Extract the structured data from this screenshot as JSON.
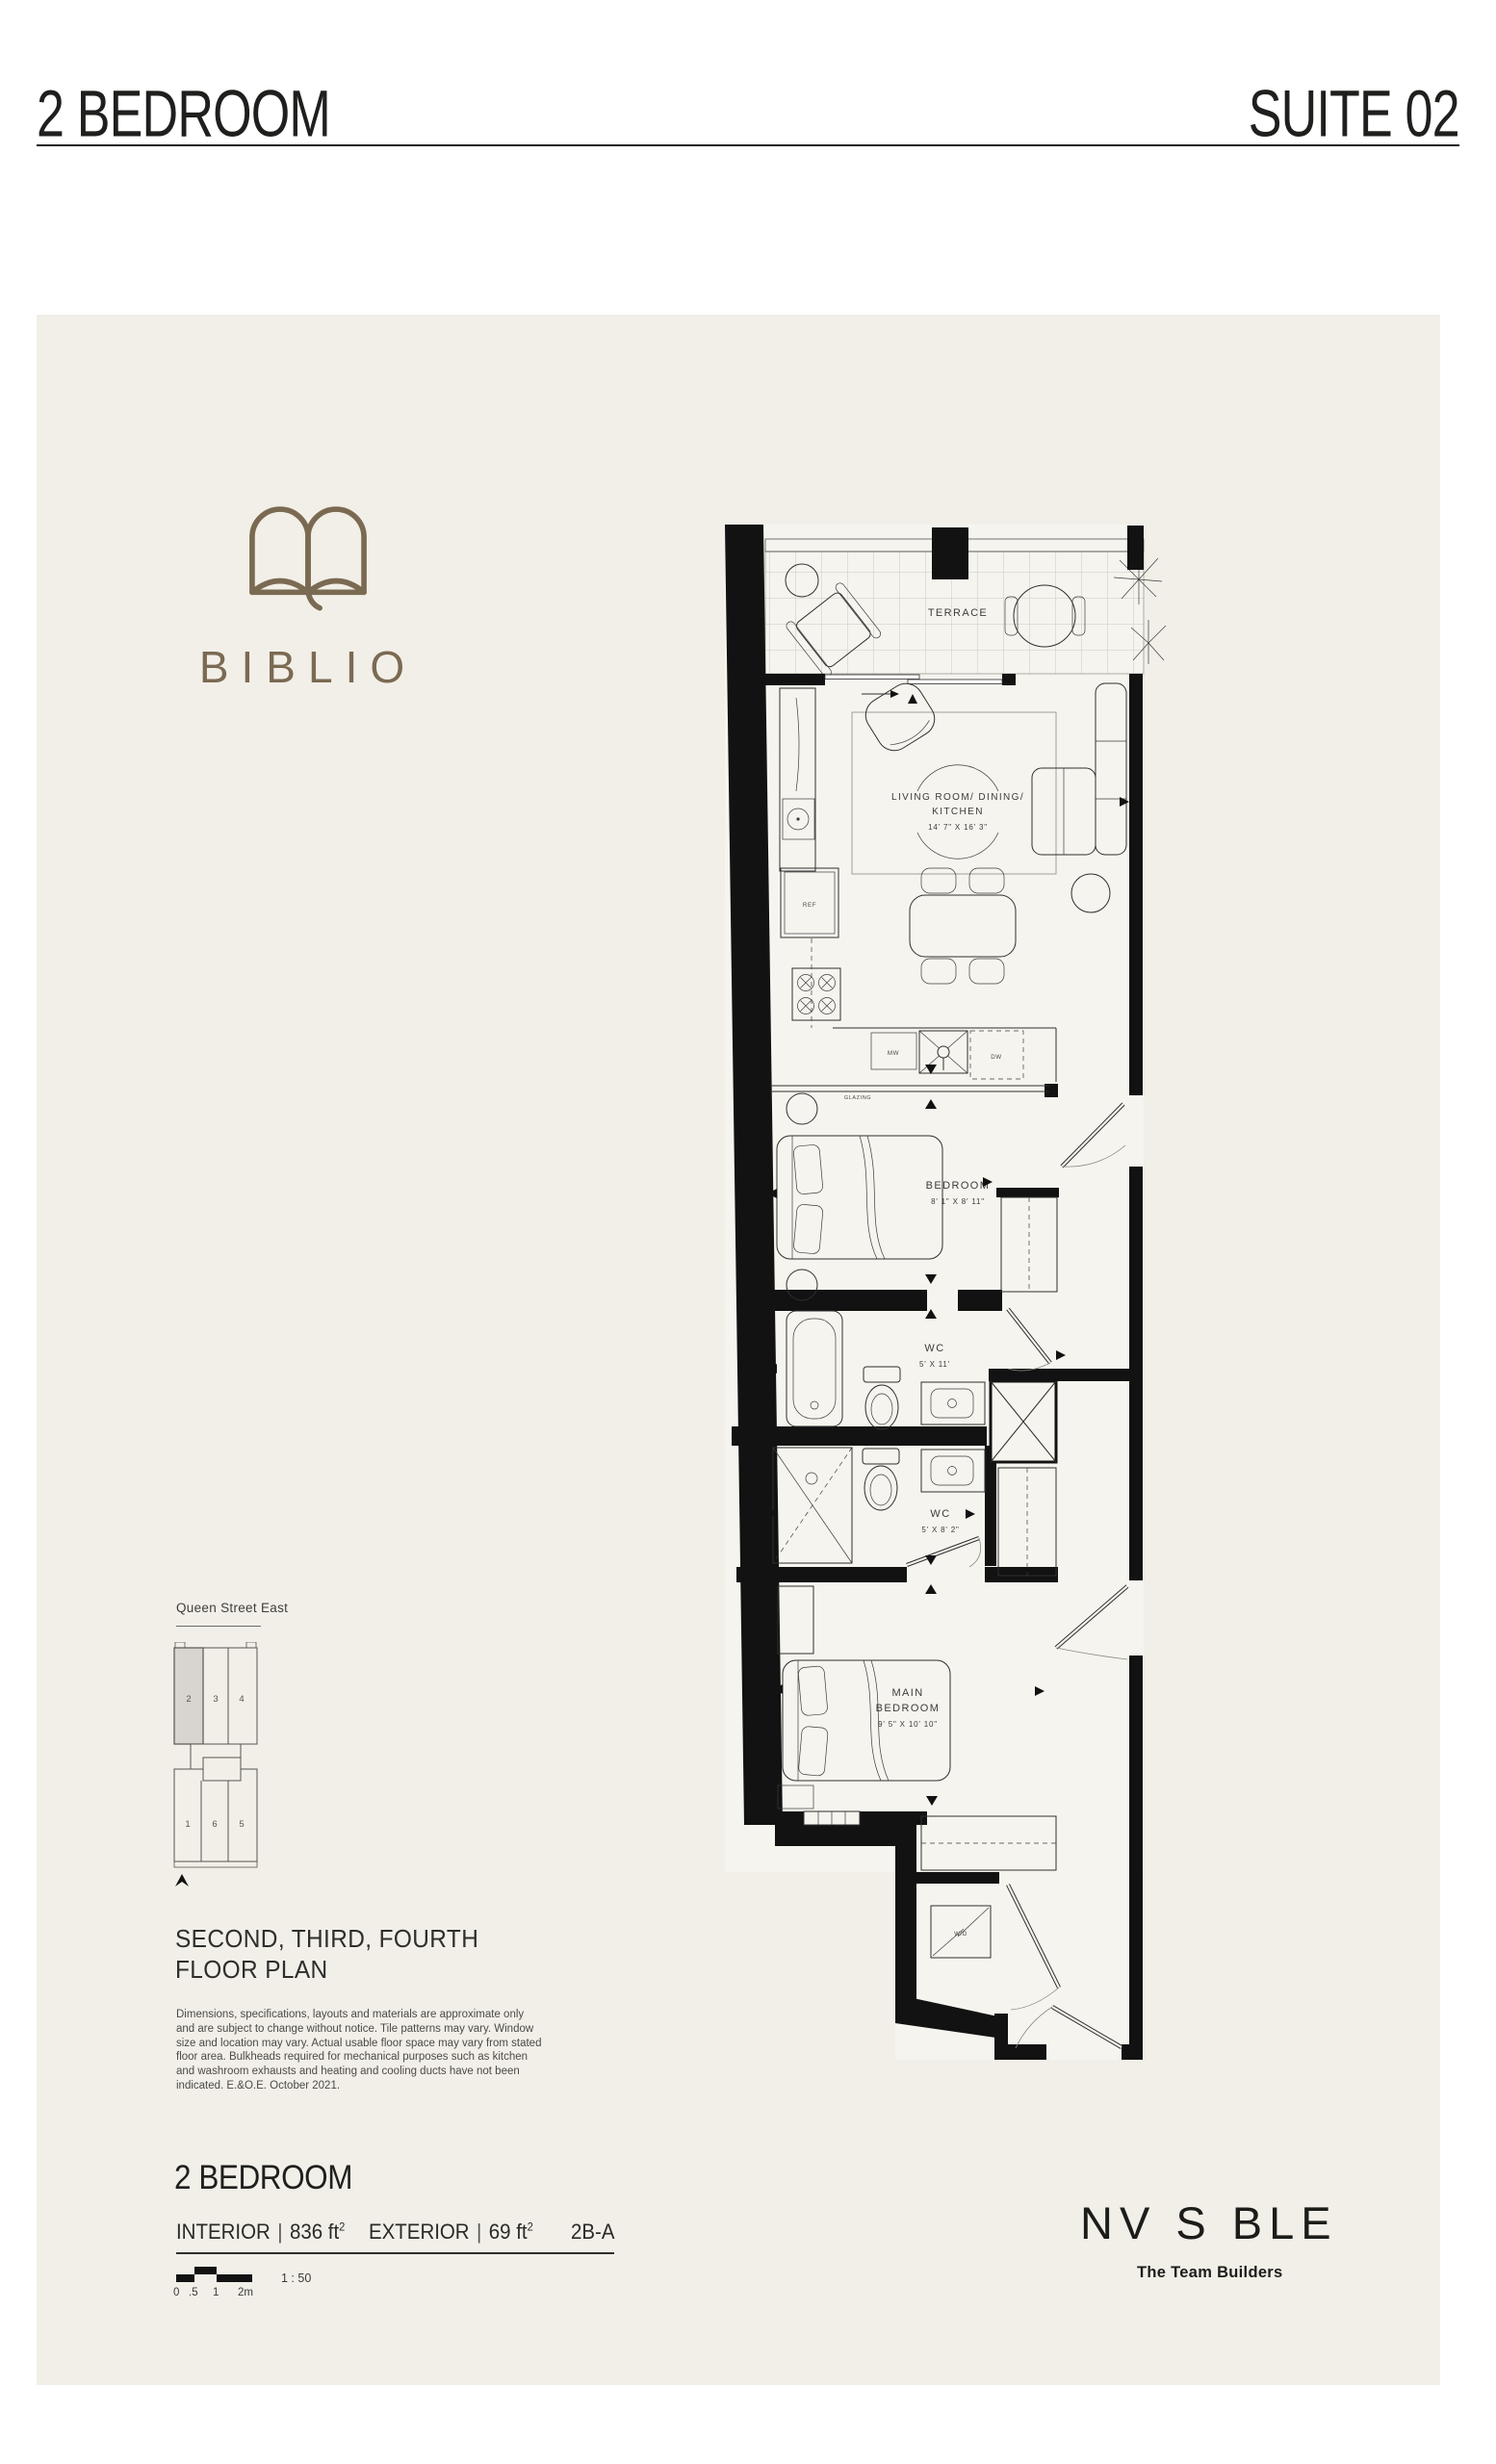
{
  "header": {
    "title": "2 BEDROOM",
    "suite": "SUITE 02"
  },
  "brand": {
    "name": "BIBLIO"
  },
  "key_plan": {
    "street": "Queen Street East",
    "suites_top": [
      "2",
      "3",
      "4"
    ],
    "suites_bottom": [
      "1",
      "6",
      "5"
    ],
    "highlighted_suite": "2"
  },
  "floor_plan_title": {
    "line1": "SECOND, THIRD, FOURTH",
    "line2": "FLOOR PLAN"
  },
  "disclaimer": "Dimensions, specifications, layouts and materials are approximate only and are subject to change without notice. Tile patterns may vary. Window size and location may vary. Actual usable floor space may vary from stated floor area. Bulkheads required for mechanical purposes such as kitchen and washroom exhausts and heating and cooling ducts have not been indicated. E.&O.E. October 2021.",
  "unit": {
    "type": "2 BEDROOM",
    "interior_label": "INTERIOR",
    "sep": "|",
    "interior_value": "836 ft",
    "interior_sup": "2",
    "exterior_label": "EXTERIOR",
    "exterior_value": "69 ft",
    "exterior_sup": "2",
    "code": "2B-A",
    "scale": "1 : 50",
    "scale_ticks": [
      "0",
      ".5",
      "1",
      "2m"
    ]
  },
  "developer": {
    "name": "NV S BLE",
    "tagline": "The Team Builders"
  },
  "plan": {
    "terrace": "TERRACE",
    "glazing": "GLAZING",
    "living": {
      "line1": "LIVING ROOM/ DINING/",
      "line2": "KITCHEN",
      "dim": "14' 7\" X 16' 3\""
    },
    "bedroom": {
      "name": "BEDROOM",
      "dim": "8' 1\" X 8' 11\""
    },
    "wc1": {
      "name": "WC",
      "dim": "5' X 11'"
    },
    "wc2": {
      "name": "WC",
      "dim": "5' X 8' 2\""
    },
    "main_bedroom": {
      "line1": "MAIN",
      "line2": "BEDROOM",
      "dim": "9' 5\" X 10' 10\""
    },
    "appliances": {
      "ref": "REF",
      "mw": "MW",
      "dw": "DW",
      "wd": "W/D"
    }
  }
}
